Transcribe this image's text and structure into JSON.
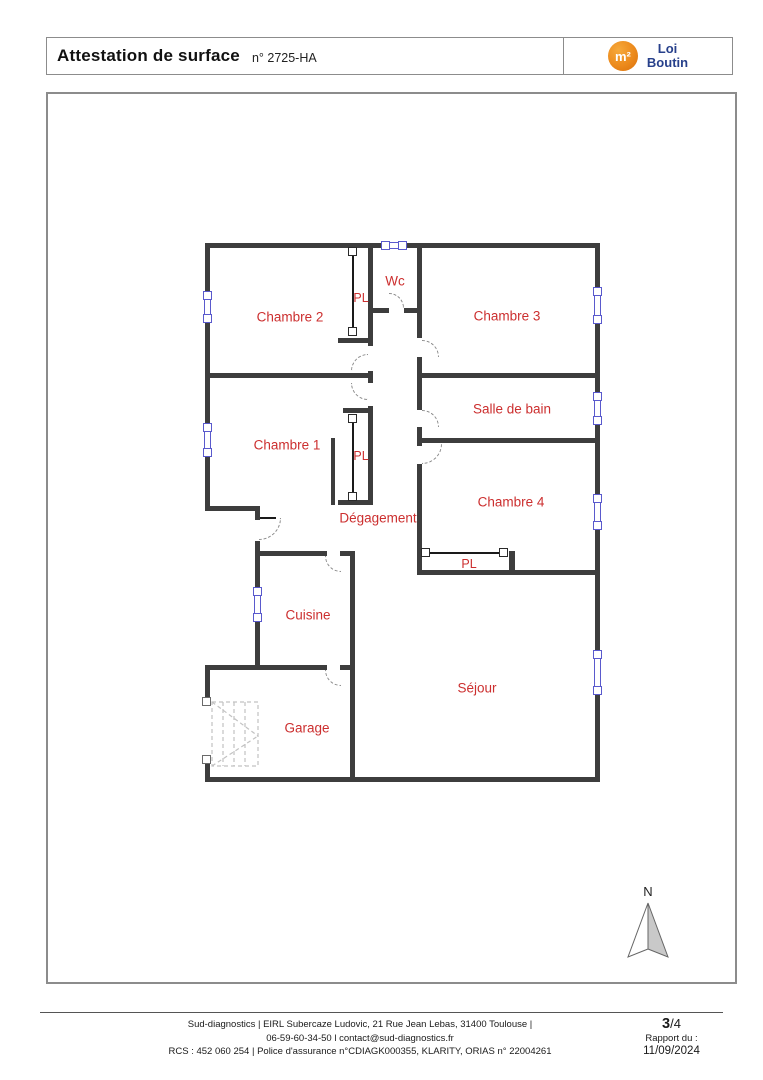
{
  "header": {
    "title": "Attestation de surface",
    "doc_number": "n° 2725-HA",
    "logo": {
      "symbol": "m²",
      "line1": "Loi",
      "line2": "Boutin"
    }
  },
  "plan": {
    "rooms": {
      "chambre2": "Chambre 2",
      "wc": "Wc",
      "chambre3": "Chambre 3",
      "chambre1": "Chambre 1",
      "salle_de_bain": "Salle de bain",
      "chambre4": "Chambre 4",
      "degagement": "Dégagement",
      "cuisine": "Cuisine",
      "sejour": "Séjour",
      "garage": "Garage",
      "placard": "PL"
    }
  },
  "compass": {
    "north": "N"
  },
  "footer": {
    "line1": "Sud-diagnostics | EIRL Subercaze Ludovic, 21 Rue Jean Lebas, 31400 Toulouse |",
    "line2": "06-59-60-34-50 l contact@sud-diagnostics.fr",
    "line3": "RCS : 452 060 254 | Police d'assurance n°CDIAGK000355, KLARITY, ORIAS n° 22004261",
    "page_current": "3",
    "page_rest": "/4",
    "report_label": "Rapport du :",
    "report_date": "11/09/2024"
  },
  "colors": {
    "wall": "#3d3d3d",
    "label_red": "#cc2f2f",
    "window_blue": "#5a5acd",
    "logo_orange": "#e8821e",
    "logo_blue": "#27408b"
  }
}
